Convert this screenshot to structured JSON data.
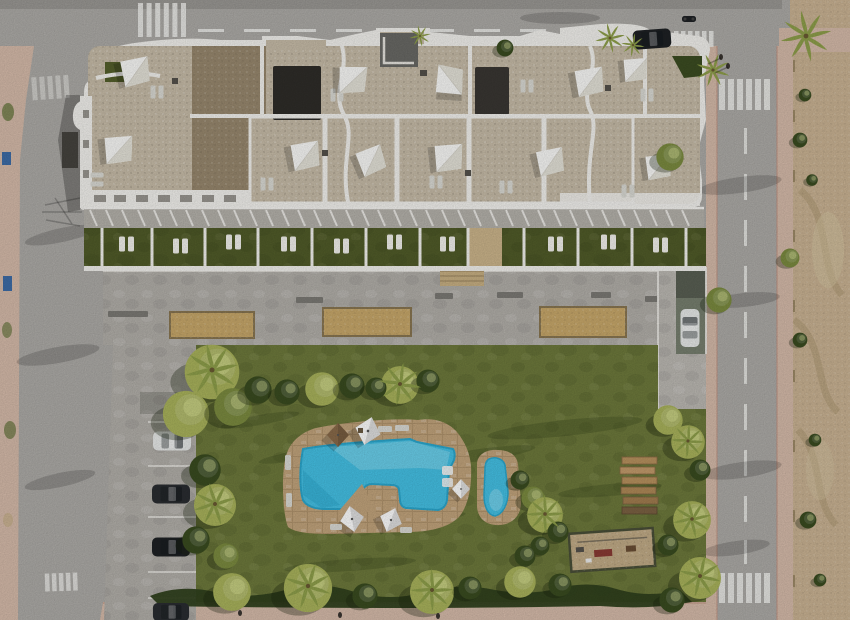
{
  "scene": {
    "description": "Top-down aerial render of a modern white apartment complex with rooftop sail-shaded terraces, ground-floor turf patios, a communal lawn garden with a free-form swimming pool and kids pool, street parking, surrounding roads with zebra crossings, and an undeveloped sandy plot to the right",
    "view": "top-down aerial"
  },
  "colors": {
    "asphalt": "#aeaca8",
    "asphalt_dark": "#9b9995",
    "sidewalk": "#d7bcab",
    "sidewalk_edge": "#c29584",
    "sand_lot": "#cbb494",
    "sand_ridge": "#b09a74",
    "lawn": "#6e7a3c",
    "turf": "#515c29",
    "gravel_light": "#c8bda9",
    "gravel_dark": "#99896f",
    "charcoal": "#2f2d29",
    "white_wall": "#f4f3ef",
    "concrete": "#b3b0aa",
    "sand_court": "#c9a96b",
    "wood": "#b9935f",
    "wood_dark": "#7c6243",
    "deck_stone": "#c3a57d",
    "pool_water": "#45c2e6",
    "pool_water_light": "#8fdef2",
    "pool_water_dark": "#2ba8cf",
    "tree_light": "#aab45c",
    "tree_mid": "#7c8c40",
    "tree_dark": "#3a4c20",
    "hedge": "#2f401c",
    "palm": "#8fa04b",
    "car_white": "#e9ebea",
    "car_dark": "#2a2d31",
    "car_black": "#1e2124",
    "road_marking": "#f2f2ef",
    "shade_sail": "#fbfbf9",
    "shade_sail_shadow": "#e6e4da",
    "lounger": "#dcdcd6",
    "parasol_brown": "#8a6b4a",
    "bin_blue": "#3e6da8"
  },
  "inventory": {
    "shade_sails": 11,
    "pools": 2,
    "petanque_courts": 3,
    "wooden_benches": 6,
    "zebra_crossings": 6,
    "parked_cars": 4,
    "cars_driving": 2,
    "motorcycles": 1,
    "playgrounds": 1
  }
}
